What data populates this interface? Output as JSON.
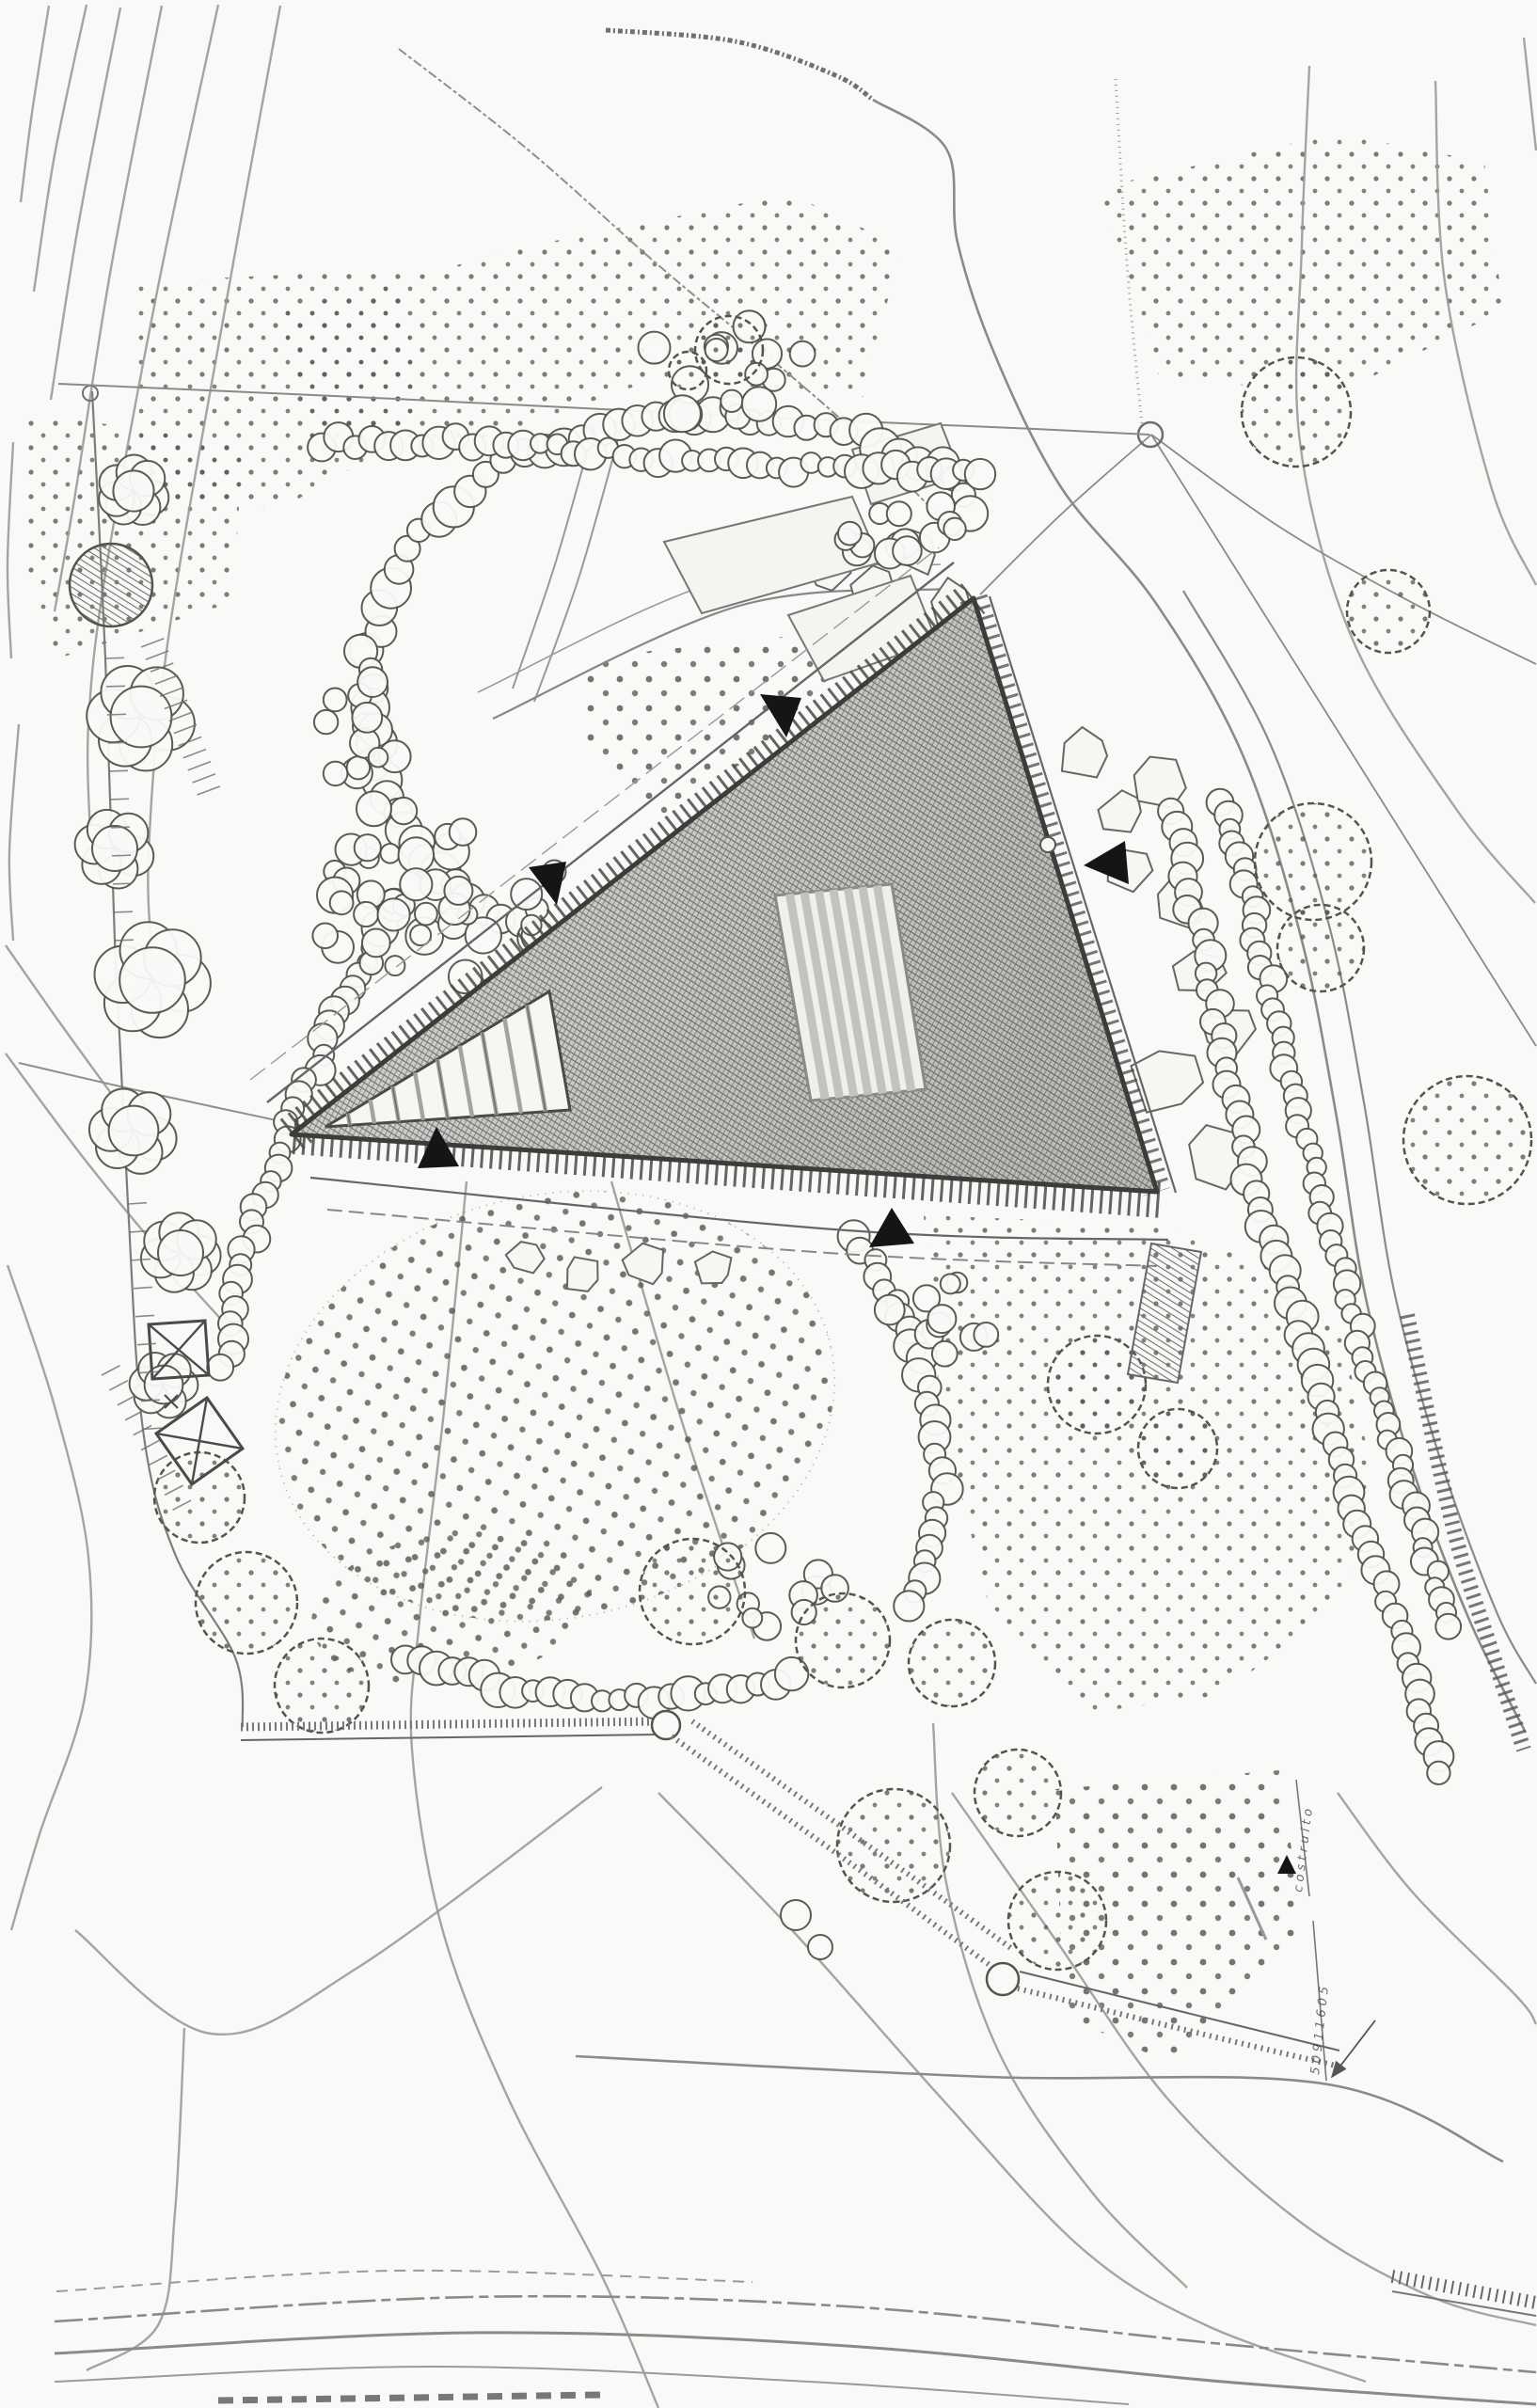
{
  "document": {
    "kind": "hand-drawn architectural site plan",
    "view": "top-down garden plan with triangular building",
    "media": "pencil sketch on paper, scanned"
  },
  "palette": {
    "paper": "#f9f9f7",
    "ink_dark": "#3c3c3a",
    "ink_mid": "#6f6f6d",
    "ink_light": "#9a9a98",
    "roof_tone": "#b9b9b6",
    "marker_black": "#151515"
  },
  "annotations": {
    "upper": {
      "text": "costruito"
    },
    "lower": {
      "text": "50911605"
    }
  },
  "features": {
    "building": {
      "shape": "triangular hatched roof",
      "skylight": "striped rooflight rectangle",
      "ramp": "striped entry wedge",
      "black_triangle_markers": 6
    },
    "symbols": {
      "crossed_squares": 2,
      "survey_node_circles": 3
    },
    "vegetation": {
      "shrub_bubble_chains": true,
      "dotted_orchard_oval": true,
      "stippled_meadows": 7,
      "contour_lines": true,
      "double_hedge_rows_along_road": true
    }
  }
}
